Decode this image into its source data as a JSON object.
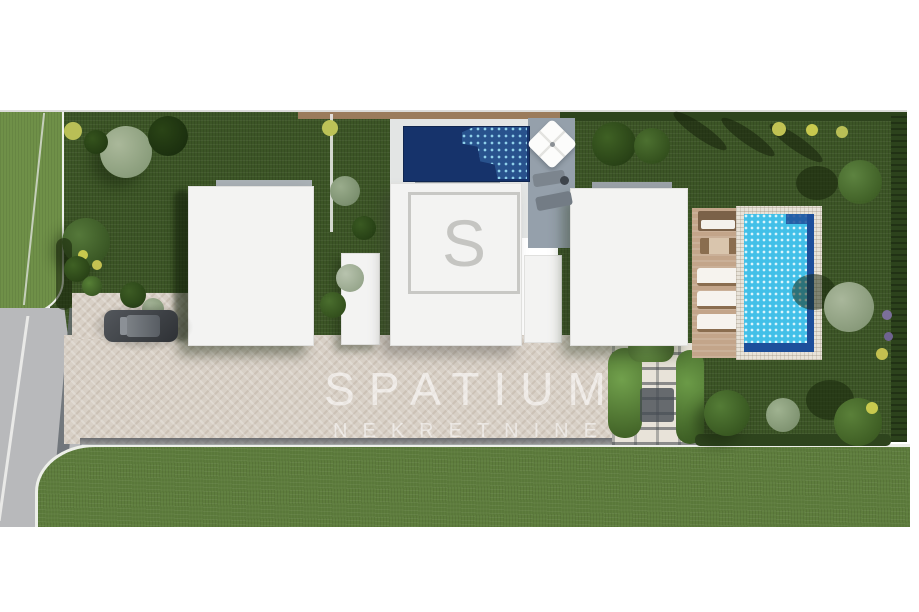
{
  "watermark": {
    "brand": "SPATIUM",
    "subtitle": "NEKRETNINE",
    "logo_letter": "S"
  },
  "scene": {
    "description": "Aerial top-down 3D architectural rendering of a residential plot with three modern flat-roof villas, a dark rooftop pool with parasol terrace, a turquoise garden pool with sun deck and loungers, landscaped gardens, a pergola, a paved driveway with a parked car and an access road on the left",
    "objects": [
      "access-road",
      "road-lane-line",
      "grass-verge",
      "driveway",
      "parked-car",
      "villa-left",
      "villa-middle",
      "villa-right",
      "annex-buildings",
      "rooftop-pool",
      "garden-pool",
      "pool-stone-border",
      "sun-deck",
      "parasol",
      "sun-loungers",
      "outdoor-table",
      "pergola-with-vines",
      "garden-trees",
      "hedge-boundary",
      "front-lawn",
      "boundary-wall",
      "flower-beds"
    ],
    "colors": {
      "garden_green": "#3c5526",
      "front_lawn": "#5e7d3d",
      "verge_green": "#6f9048",
      "road_gray": "#b8b9bb",
      "paving_beige": "#d8d0c6",
      "roof_white": "#f3f3f2",
      "pool_deep_blue": "#16336b",
      "pool_turquoise": "#42c0e8",
      "pool_edge_blue": "#1d4f9b",
      "deck_tan": "#c3a58a",
      "hedge_dark": "#2e441d",
      "wall_brown": "#9b7c5c",
      "watermark_white": "#ffffff"
    }
  }
}
